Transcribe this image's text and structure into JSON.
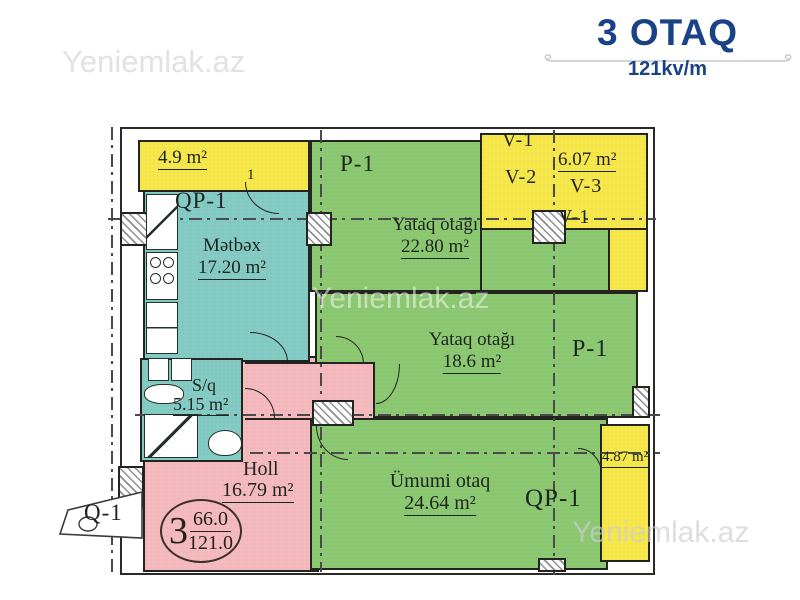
{
  "header": {
    "title": "3 OTAQ",
    "subtitle": "121kv/m"
  },
  "watermark": {
    "top_left": "Yeniemlak.az",
    "center": "Yeniemlak.az",
    "bottom_right": "Yeniemlak.az"
  },
  "plan": {
    "balcony_top_left": {
      "area": "4.9 m²"
    },
    "door_no": "1",
    "qp1_top_tag": "QP-1",
    "kitchen": {
      "name": "Mətbəx",
      "area": "17.20 m²"
    },
    "bedroom_top": {
      "tag": "P-1",
      "name": "Yataq otağı",
      "area": "22.80 m²"
    },
    "vest": {
      "v1_top": "V-1",
      "v2": "V-2",
      "area": "6.07 m²",
      "v3": "V-3",
      "v1_box": "V-1"
    },
    "bedroom_mid": {
      "name": "Yataq otağı",
      "area": "18.6 m²",
      "tag": "P-1"
    },
    "bathroom": {
      "name": "S/q",
      "area": "5.15 m²"
    },
    "hall": {
      "name": "Holl",
      "area": "16.79 m²"
    },
    "living": {
      "name": "Ümumi otaq",
      "area": "24.64 m²",
      "tag": "QP-1"
    },
    "balcony_right": {
      "area": "4.87 m²"
    },
    "entrance_tag": "Q-1",
    "stamp": {
      "rooms": "3",
      "numerator": "66.0",
      "denominator": "121.0"
    }
  },
  "colors": {
    "accent_navy": "#1a4286",
    "balcony_yellow": "#f6e74b",
    "wet_area_teal": "#84cbc4",
    "room_green": "#8cc871",
    "hall_pink": "#f4babd",
    "wall_black": "#23231f",
    "watermark_gray": "#e2e2e6"
  }
}
